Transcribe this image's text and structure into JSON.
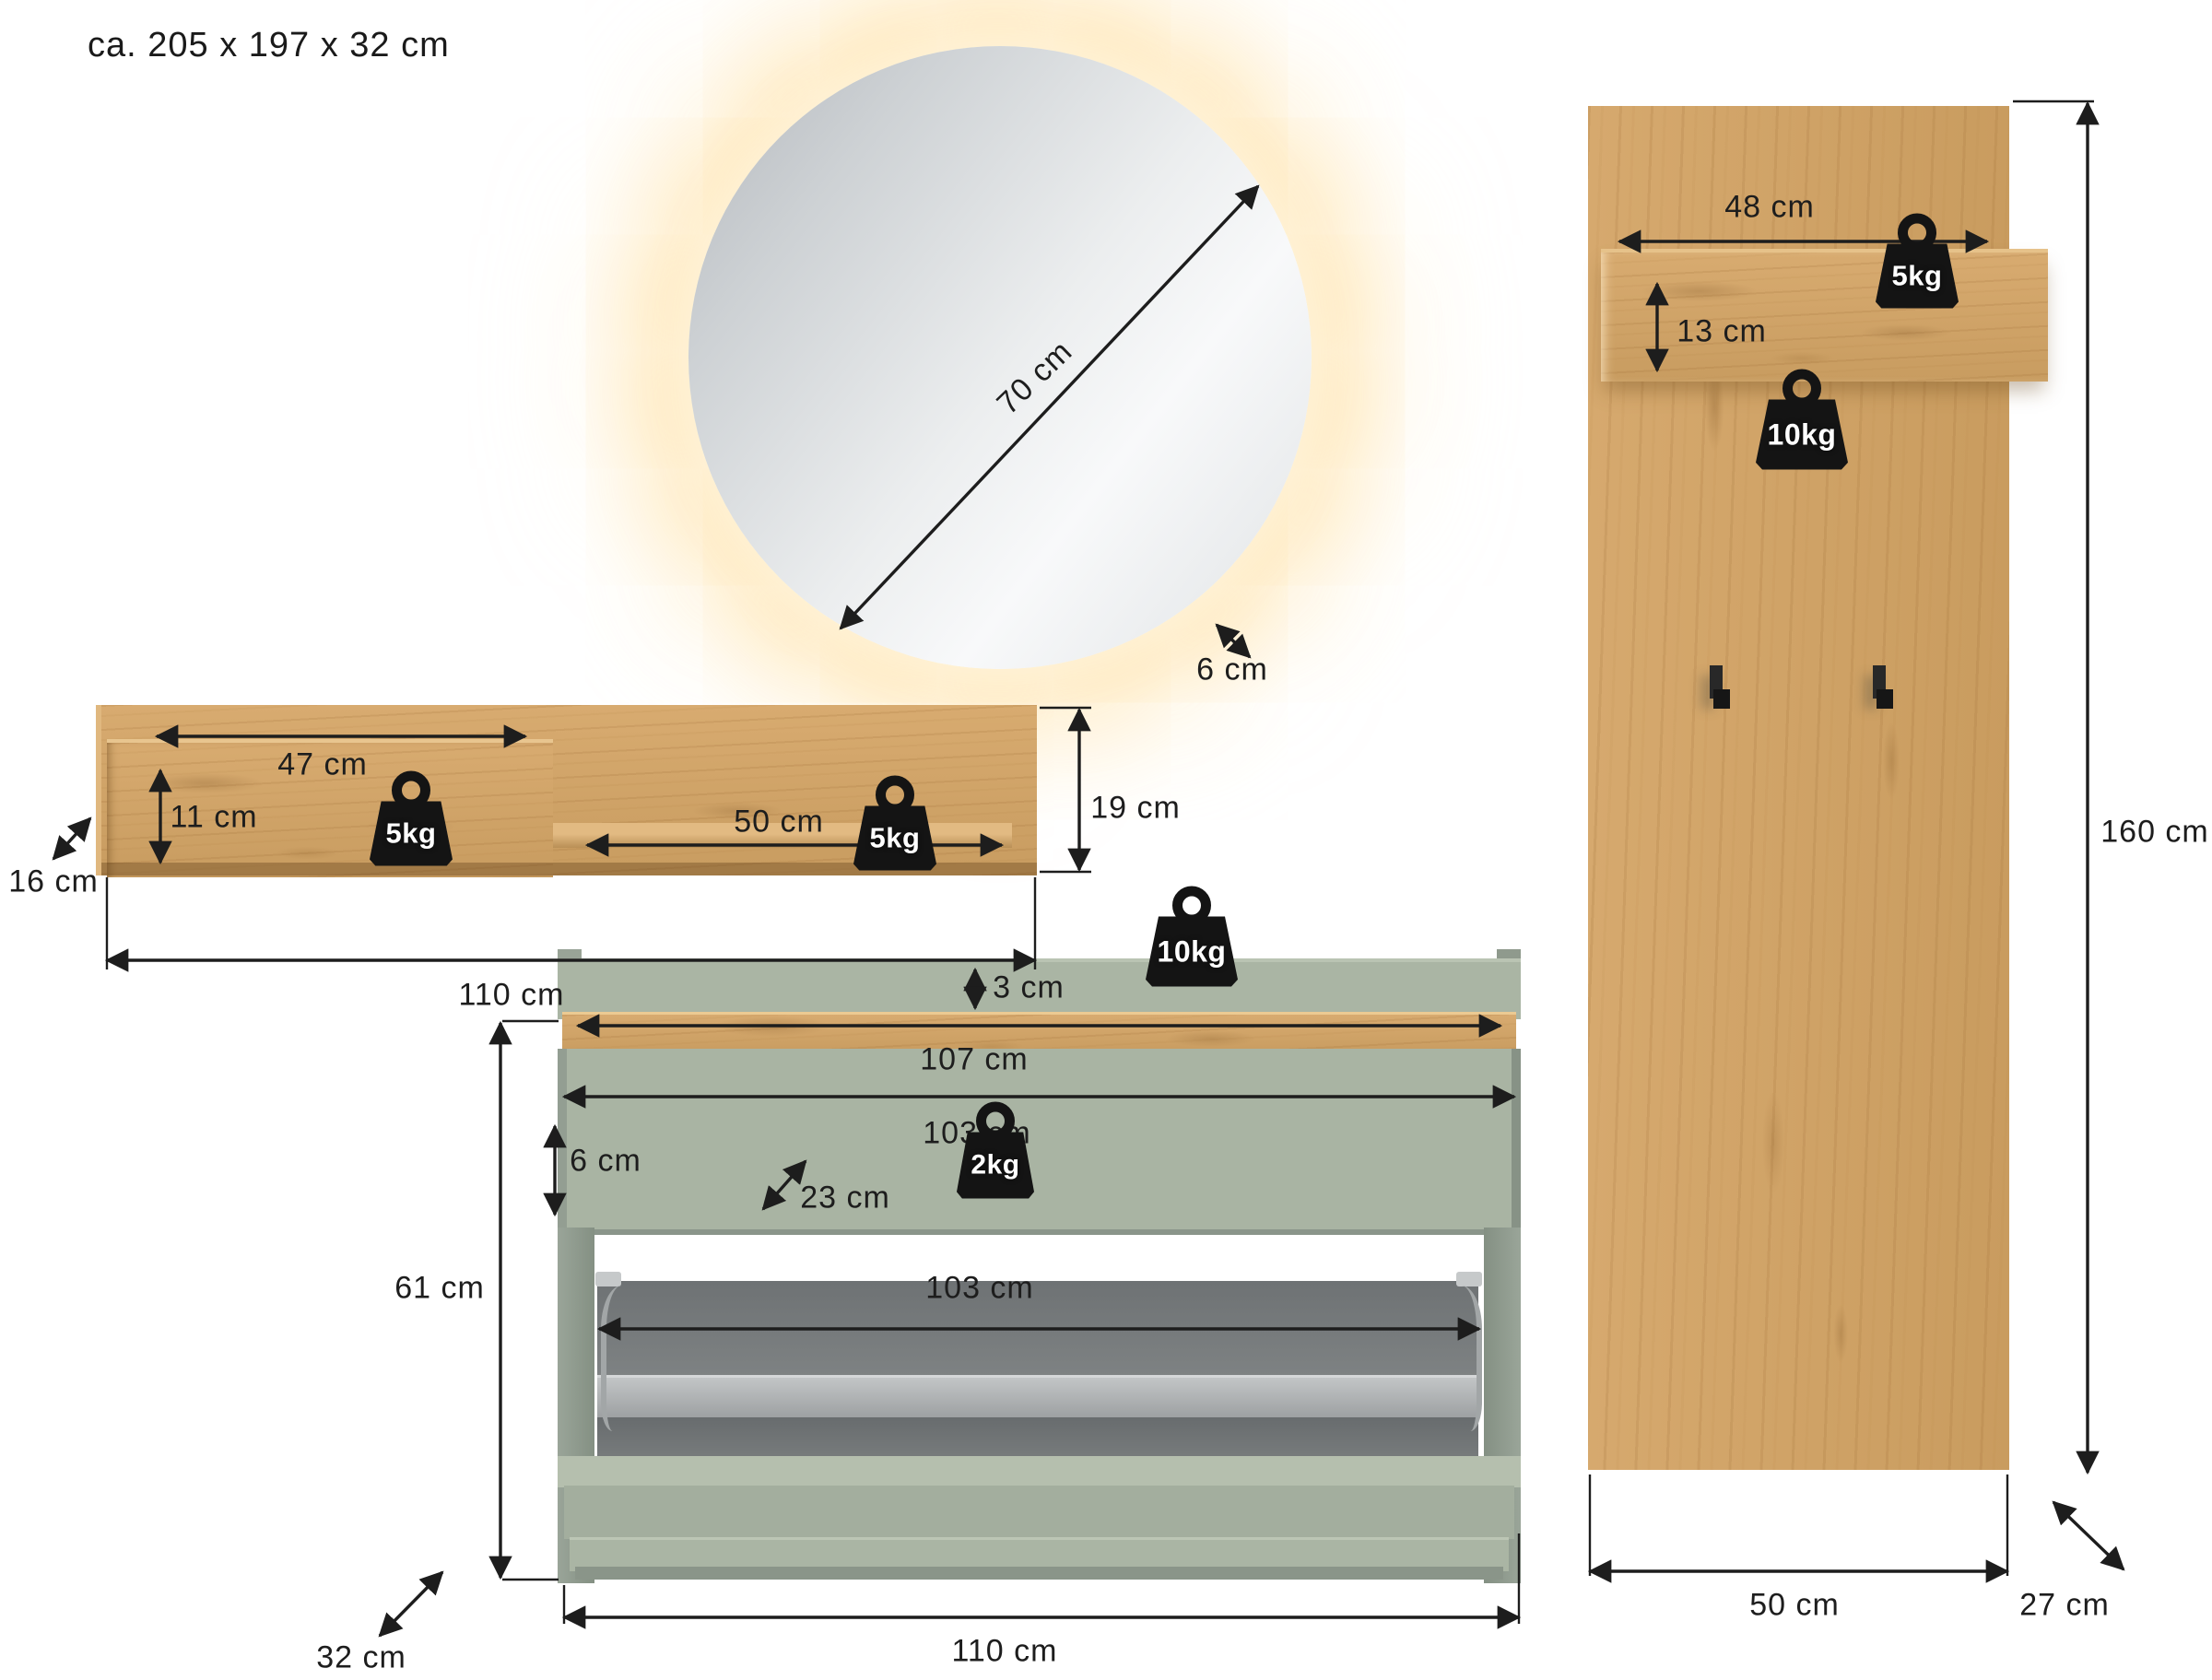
{
  "title": "ca. 205 x 197 x 32 cm",
  "colors": {
    "wood": "#d1a46a",
    "sage_green": "#a9b4a3",
    "led_glow": "#ffe3ad",
    "flap_gray": "#75797a",
    "dimension_ink": "#1d1d1d"
  },
  "mirror": {
    "diameter": "70 cm",
    "depth": "6 cm"
  },
  "wall_shelf": {
    "left_section_width": "47 cm",
    "left_section_height": "11 cm",
    "left_max_load": "5kg",
    "right_section_width": "50 cm",
    "right_max_load": "5kg",
    "side_height": "19 cm",
    "depth": "16 cm",
    "total_width": "110 cm"
  },
  "wardrobe_panel": {
    "shelf_width": "48 cm",
    "shelf_height": "13 cm",
    "shelf_max_load": "5kg",
    "panel_max_load": "10kg",
    "height": "160 cm",
    "width": "50 cm",
    "depth": "27 cm"
  },
  "shoe_bench": {
    "rim_height": "3 cm",
    "top_width": "107 cm",
    "flap_width": "103 cm",
    "flap_height": "6 cm",
    "flap_depth": "23 cm",
    "flap_max_load": "2kg",
    "top_max_load": "10kg",
    "opening_width": "103 cm",
    "height": "61 cm",
    "total_width": "110 cm",
    "depth": "32 cm"
  }
}
